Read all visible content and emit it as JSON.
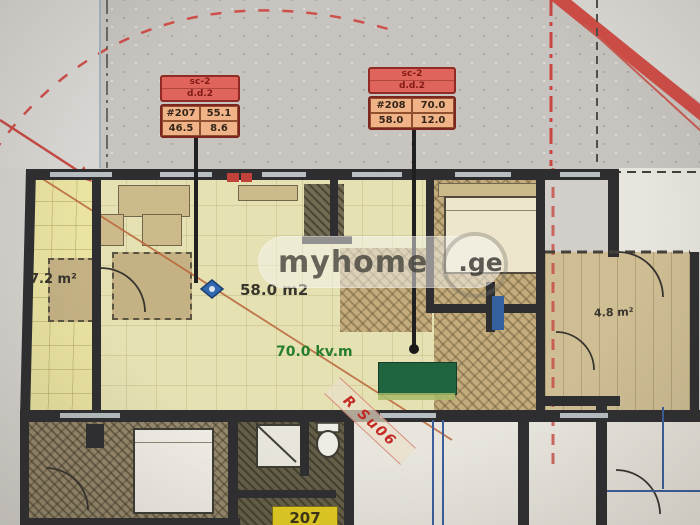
{
  "units": [
    {
      "header1": "sc-2",
      "header2": "d.d.2",
      "values": [
        [
          "#207",
          "55.1"
        ],
        [
          "46.5",
          "8.6"
        ]
      ]
    },
    {
      "header1": "sc-2",
      "header2": "d.d.2",
      "values": [
        [
          "#208",
          "70.0"
        ],
        [
          "58.0",
          "12.0"
        ]
      ]
    }
  ],
  "areas": {
    "left_balcony": "7.2 m²",
    "living": "58.0 m2",
    "total": "70.0 kv.m",
    "right_balcony": "4.8 m²"
  },
  "lower_unit_tag": "207",
  "stamp_text": "R Su06",
  "watermark": {
    "brand": "myhome",
    "suffix": ".ge"
  },
  "colors": {
    "boundary_red": "#cf4742",
    "label_header_red": "#e06058",
    "label_value_orange": "#f2b387",
    "marker_green": "#17603a",
    "total_text_green": "#1e7a28",
    "stamp_red": "#c4231f",
    "tag_yellow": "#e3cc1d",
    "marker_blue": "#2a63b4"
  }
}
